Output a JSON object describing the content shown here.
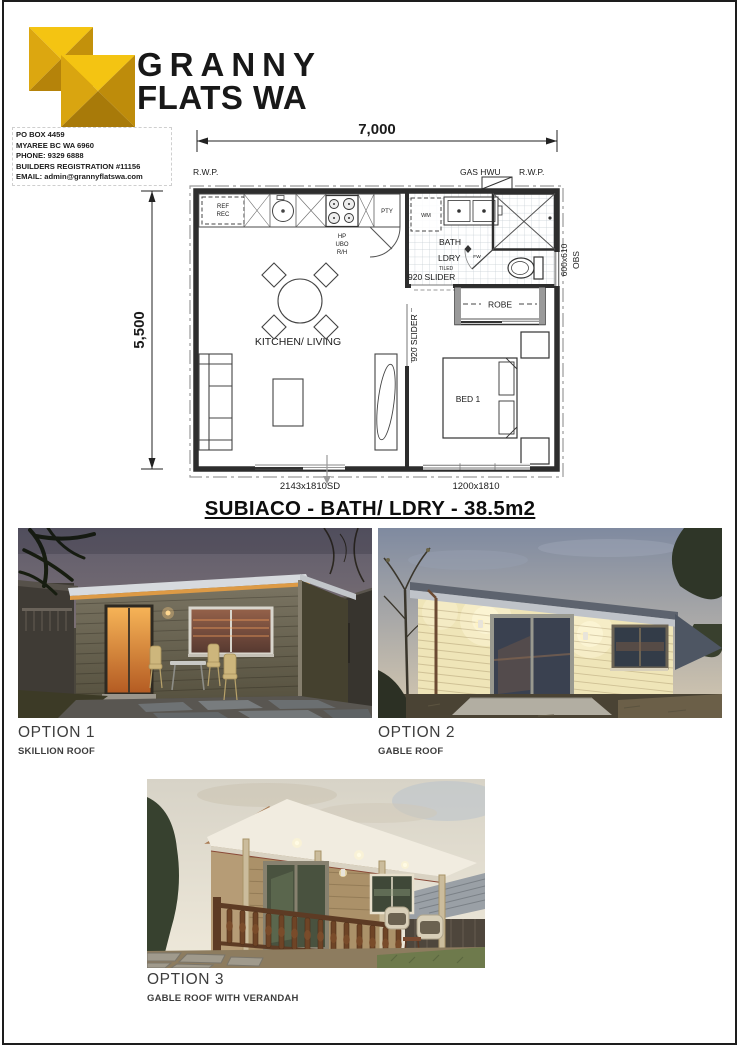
{
  "brand": {
    "name_line1": "GRANNY",
    "name_line2": "FLATS WA",
    "gold_light": "#F4C412",
    "gold_mid": "#DCA710",
    "gold_dark": "#C3910B",
    "gold_deep": "#A87C09"
  },
  "contact": {
    "po_box": "PO BOX 4459",
    "suburb": "MYAREE BC WA 6960",
    "phone": "PHONE:  9329 6888",
    "registration": "BUILDERS REGISTRATION  #11156",
    "email": "EMAIL:  admin@grannyflatswa.com"
  },
  "floorplan": {
    "title": "SUBIACO - BATH/ LDRY - 38.5m2",
    "dim_width": "7,000",
    "dim_height": "5,500",
    "rwp_left": "R.W.P.",
    "gas_hwu": "GAS HWU",
    "rwp_right": "R.W.P.",
    "ref_line1": "REF",
    "ref_line2": "REC",
    "pty": "PTY",
    "hp": "HP",
    "ubo": "UBO",
    "rh": "R/H",
    "wm": "WM",
    "bath": "BATH",
    "ldry": "LDRY",
    "tiled": "TILED",
    "fw": "FW",
    "slider_bath": "920 SLIDER",
    "slider_bed": "920 SLIDER",
    "obs_size": "600x610",
    "obs": "OBS",
    "robe": "ROBE",
    "bed": "BED 1",
    "kitchen_living": "KITCHEN/ LIVING",
    "door_bottom": "2143x1810SD",
    "window_bottom": "1200x1810"
  },
  "options": [
    {
      "label": "OPTION 1",
      "sub": "SKILLION ROOF"
    },
    {
      "label": "OPTION 2",
      "sub": "GABLE ROOF"
    },
    {
      "label": "OPTION 3",
      "sub": "GABLE ROOF WITH VERANDAH"
    }
  ]
}
